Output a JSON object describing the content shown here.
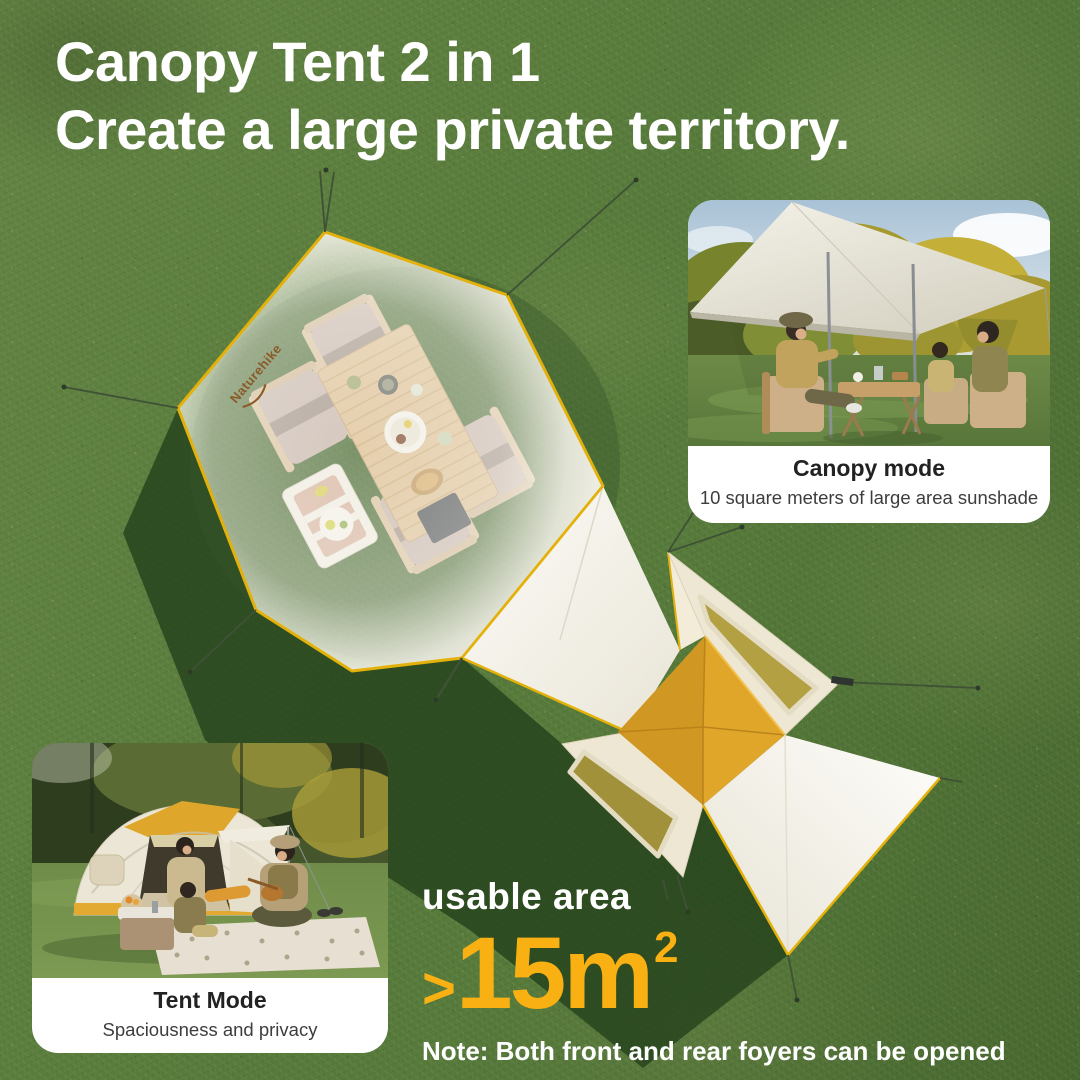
{
  "headline": {
    "line1": "Canopy Tent 2 in 1",
    "line2": "Create a large private territory."
  },
  "canopy_card": {
    "title": "Canopy mode",
    "subtitle": "10 square meters of large area sunshade"
  },
  "tent_card": {
    "title": "Tent Mode",
    "subtitle": "Spaciousness and privacy"
  },
  "usable_area": {
    "label": "usable area",
    "prefix": ">",
    "value": "15m",
    "superscript": "2",
    "note": "Note: Both front and rear foyers can be opened"
  },
  "brand": {
    "logo_text": "Naturehike"
  },
  "colors": {
    "accent_orange": "#F9B013",
    "trim_yellow": "#E3B10A",
    "roof_yellow": "#DDA32A",
    "grass_green": "#567A3B",
    "fabric_white": "#F7F5EF",
    "headline_white": "#FFFFFF",
    "caption_title": "#222222",
    "caption_subtitle": "#3D3D3D",
    "shadow_green": "#24411B"
  }
}
